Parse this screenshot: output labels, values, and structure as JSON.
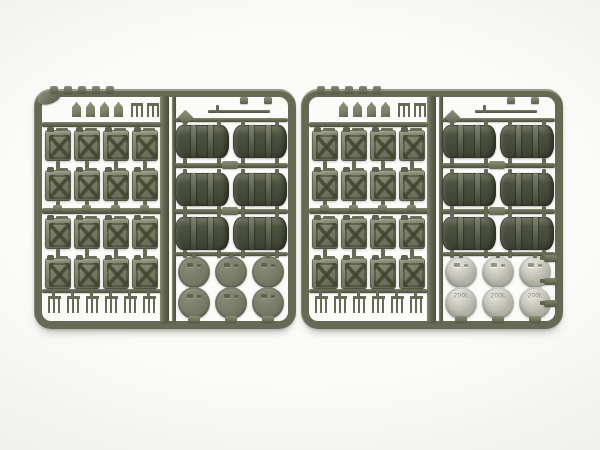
{
  "scene": {
    "type": "photograph",
    "subject": "Two olive-drab plastic model kit sprues containing jerry cans, fuel drums and drum lids on a white background",
    "sprue_count": 2
  },
  "colors": {
    "bg_center": "#fbfbf9",
    "bg_edge": "#dbdbd9",
    "frame": "#666a55",
    "jerry_body": "#7e8269",
    "drum_body": "#4d5241",
    "lid_dark": "#757966",
    "lid_light": "#b6b5ab",
    "lid_text": "#7c7b70"
  },
  "counts": {
    "jerry_rows": 4,
    "jerry_cols": 4,
    "drum_rows": 3,
    "drum_cols": 2,
    "lid_rows": 2,
    "lid_cols": 3,
    "top_caps": 5,
    "top_spouts": 4,
    "top_forks": 2,
    "bottom_forks": 6,
    "edge_taps": 3,
    "drum_hang_caps": 2
  },
  "sprues": [
    {
      "id": "left",
      "lid_style": "dark",
      "lid_label": "",
      "has_corner_tab": true,
      "has_edge_taps": false
    },
    {
      "id": "right",
      "lid_style": "light",
      "lid_label": "200L",
      "has_corner_tab": false,
      "has_edge_taps": true
    }
  ]
}
